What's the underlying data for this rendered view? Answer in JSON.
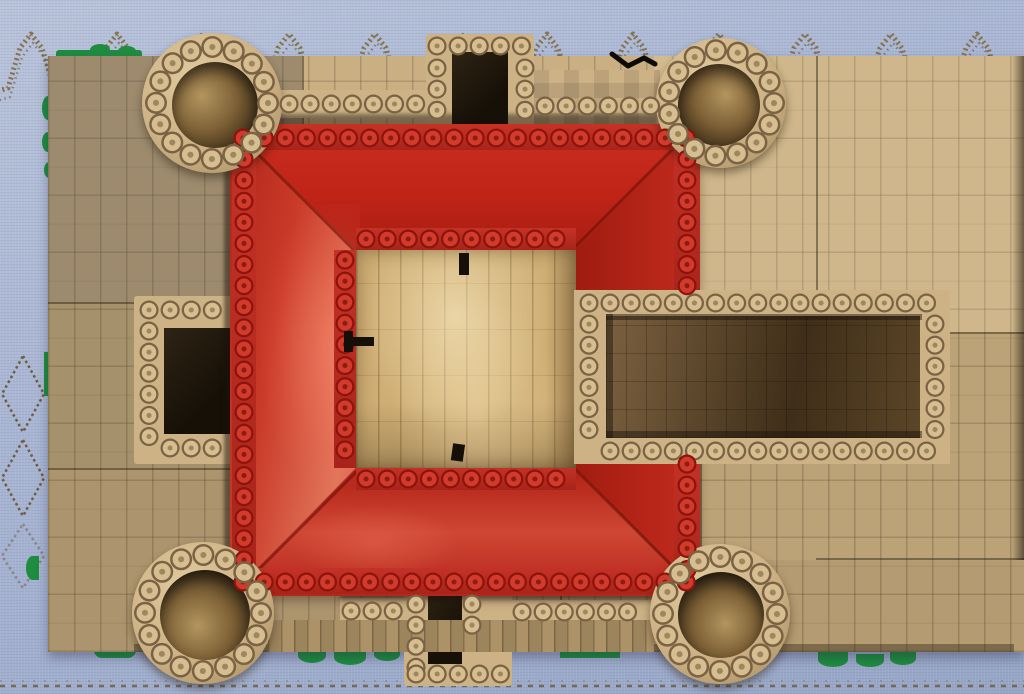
{
  "meta": {
    "type": "photograph",
    "subject": "Top-down aerial view of a LEGO castle model with red hip roof, four round corner towers, tan brick courtyard and walled annex, photographed on a light blue embroidered tablecloth"
  },
  "palette": {
    "fabric": "#a7b4d2",
    "fabricLight": "#b9c3da",
    "fabricDark": "#97a6c6",
    "trim": "#8a7750",
    "trimDark": "#5f4e33",
    "ground": "#c3a97c",
    "groundLight": "#d5bd90",
    "groundShade": "#8f8370",
    "wall": "#cdb286",
    "stud": "#d6bd8f",
    "studEdge": "#7a6345",
    "studCore": "#8a7150",
    "red": "#c2281b",
    "redDark": "#9d1a10",
    "redLight": "#e2755b",
    "ridge": "#c53227",
    "redStud": "#d23a2b",
    "redStudEdge": "#8c140d",
    "court": "#cfae74",
    "courtLight": "#efdcab",
    "encA": "#7c6140",
    "encB": "#3f2e19",
    "green": "#1f8c40",
    "dark": "#171007"
  },
  "elements": {
    "background": {
      "label": "light blue woven tablecloth with tan embroidered zigzag trim and diamond motifs"
    },
    "ground": {
      "label": "tan LEGO brick pavement baseplates with visible seams and green baseplate edges"
    },
    "castle": {
      "label": "LEGO castle keep seen from directly above",
      "roof": {
        "label": "red hip roof ring with studded ridge rows and central courtyard opening"
      },
      "courtyard": {
        "label": "glossy marbled tan tile courtyard with black clip details"
      },
      "towers": [
        {
          "label": "hollow round tower",
          "position": "top-left"
        },
        {
          "label": "hollow round tower",
          "position": "top-right"
        },
        {
          "label": "hollow round tower",
          "position": "bottom-left"
        },
        {
          "label": "hollow round tower",
          "position": "bottom-right"
        }
      ],
      "gatehouses": [
        {
          "label": "north gatehouse with dark passage",
          "position": "top-center"
        },
        {
          "label": "south gatehouse with dark passage",
          "position": "bottom-center"
        },
        {
          "label": "west bastion opening toward the keep",
          "position": "left-middle"
        }
      ],
      "enclosure": {
        "label": "stud-topped walled annex with dark brick floor",
        "position": "east"
      }
    }
  }
}
